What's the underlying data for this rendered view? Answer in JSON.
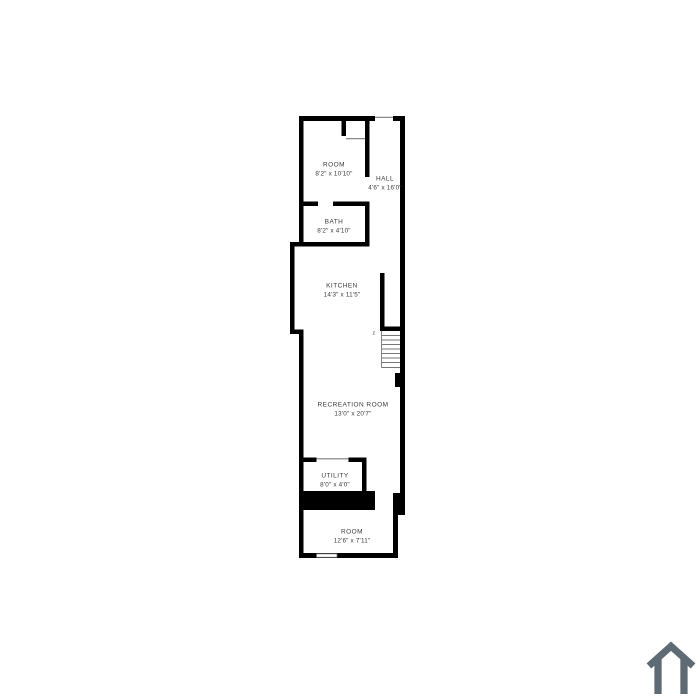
{
  "plan": {
    "rooms": [
      {
        "name": "ROOM",
        "dims": "8'2\" x 10'10\""
      },
      {
        "name": "HALL",
        "dims": "4'6\" x 16'0\""
      },
      {
        "name": "BATH",
        "dims": "8'2\" x 4'10\""
      },
      {
        "name": "KITCHEN",
        "dims": "14'3\" x 11'5\""
      },
      {
        "name": "RECREATION ROOM",
        "dims": "13'0\" x 20'7\""
      },
      {
        "name": "UTILITY",
        "dims": "8'0\" x 4'0\""
      },
      {
        "name": "ROOM",
        "dims": "12'6\" x 7'11\""
      }
    ],
    "stair_mark": "z"
  },
  "colors": {
    "background": "#ffffff",
    "wall": "#000000",
    "label_text": "#3a3a3a",
    "opening_line": "#7a7a7a",
    "logo_gray": "#5e6a74"
  },
  "branding": {
    "logo": "house-icon"
  }
}
